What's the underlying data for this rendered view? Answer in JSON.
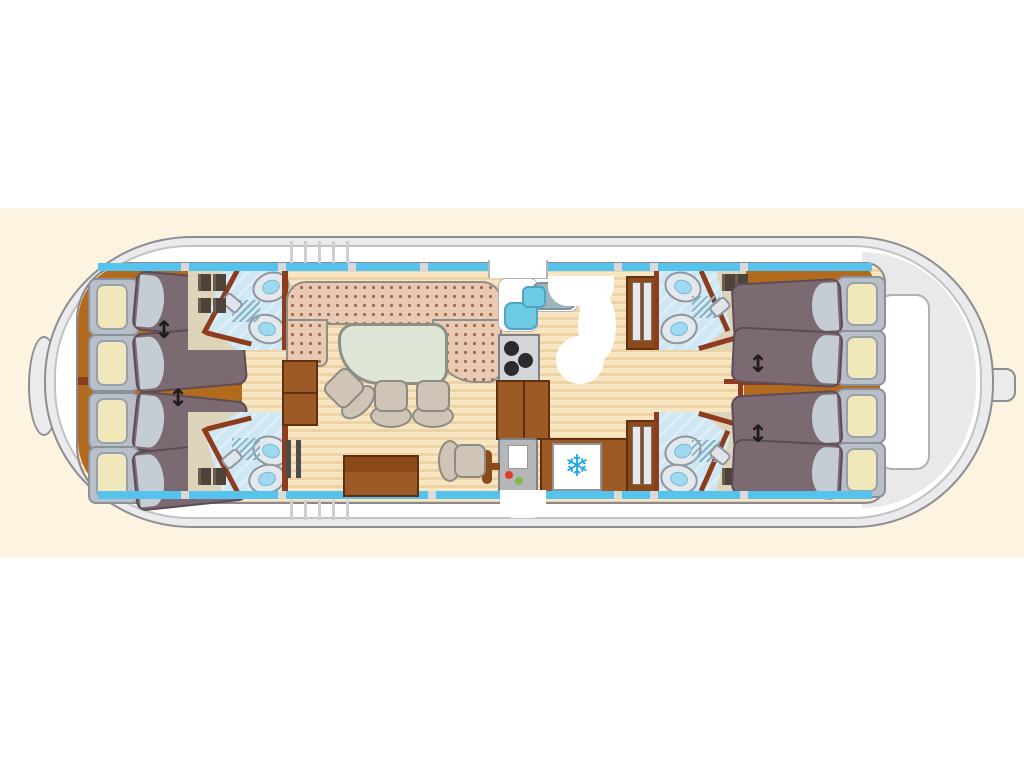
{
  "diagram": {
    "type": "houseboat-deck-plan",
    "view": "top-down floor plan of a canal houseboat, bow left, stern right"
  },
  "icons": {
    "snowflake": "❄",
    "bed-join-arrow": "↕"
  },
  "inventory": {
    "bow_cabin_beds": 4,
    "stern_cabin_beds": 4,
    "bathrooms": 4,
    "showers": 4,
    "toilets": 4,
    "sinks": 4,
    "wardrobes": 4,
    "stove_burners": 3,
    "fridge": 1,
    "helm_console": 1,
    "helm_seat": 1,
    "dinette_chairs": 3,
    "u_shaped_sofa": 1,
    "dinette_table": 1,
    "bed_join_arrows": 4
  },
  "colors": {
    "background": "#ffffff",
    "cream_band": "#fcf3e1",
    "hull": "#ebebee",
    "hull_stroke": "#8e8e92",
    "deck": "#ffffff",
    "window_blue": "#56c2ee",
    "wood_floor_light": "#f8e5c2",
    "wood_floor_dark": "#edd2a6",
    "cabin_brown_floor": "#b26a1f",
    "bulkhead_red": "#8e3c1e",
    "mattress": "#7c6a73",
    "pillow": "#f0e7bb",
    "sofa": "#e9c9b4",
    "sofa_dots": "#9a6a50",
    "table": "#dee4d6",
    "bath_tile": "#cfe7f3",
    "wardrobe": "#ded4ba",
    "counter_brown": "#9c5a26",
    "snowflake_blue": "#1ba6e8",
    "button_red": "#e23c2a",
    "button_green": "#83bb47"
  }
}
